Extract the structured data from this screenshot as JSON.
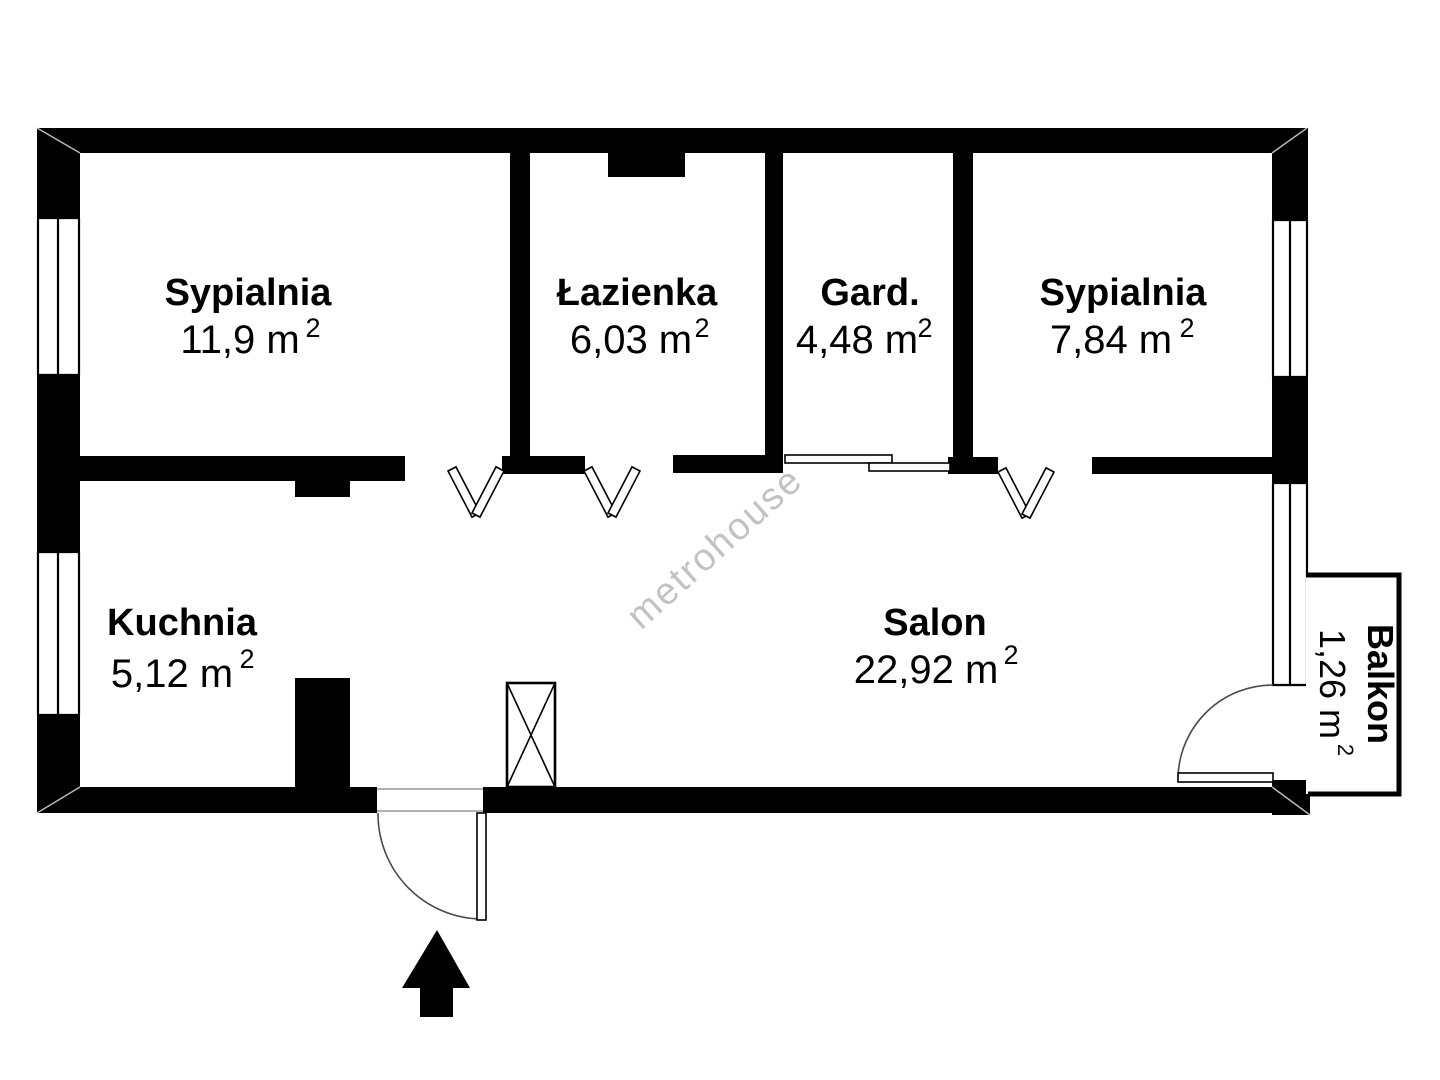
{
  "rooms": [
    {
      "name": "Sypialnia",
      "area": "11,9 m",
      "sup": "2"
    },
    {
      "name": "Łazienka",
      "area": "6,03 m",
      "sup": "2"
    },
    {
      "name": "Gard.",
      "area": "4,48 m",
      "sup": "2"
    },
    {
      "name": "Sypialnia",
      "area": "7,84 m",
      "sup": "2"
    },
    {
      "name": "Kuchnia",
      "area": "5,12 m",
      "sup": "2"
    },
    {
      "name": "Salon",
      "area": "22,92 m",
      "sup": "2"
    },
    {
      "name": "Balkon",
      "area": "1,26 m",
      "sup": "2"
    }
  ],
  "watermark": "metrohouse",
  "icons": {
    "entrance": "arrow-up-icon",
    "shaft": "crossed-box-icon",
    "room_doors": "v-swing-door-icon",
    "wardrobe_door": "sliding-door-icon",
    "balcony_door": "quarter-arc-door-icon",
    "entry_door": "quarter-arc-door-icon"
  },
  "colors": {
    "wall": "#000000",
    "background": "#ffffff",
    "watermark": "#9a9a9a",
    "text": "#000000"
  }
}
